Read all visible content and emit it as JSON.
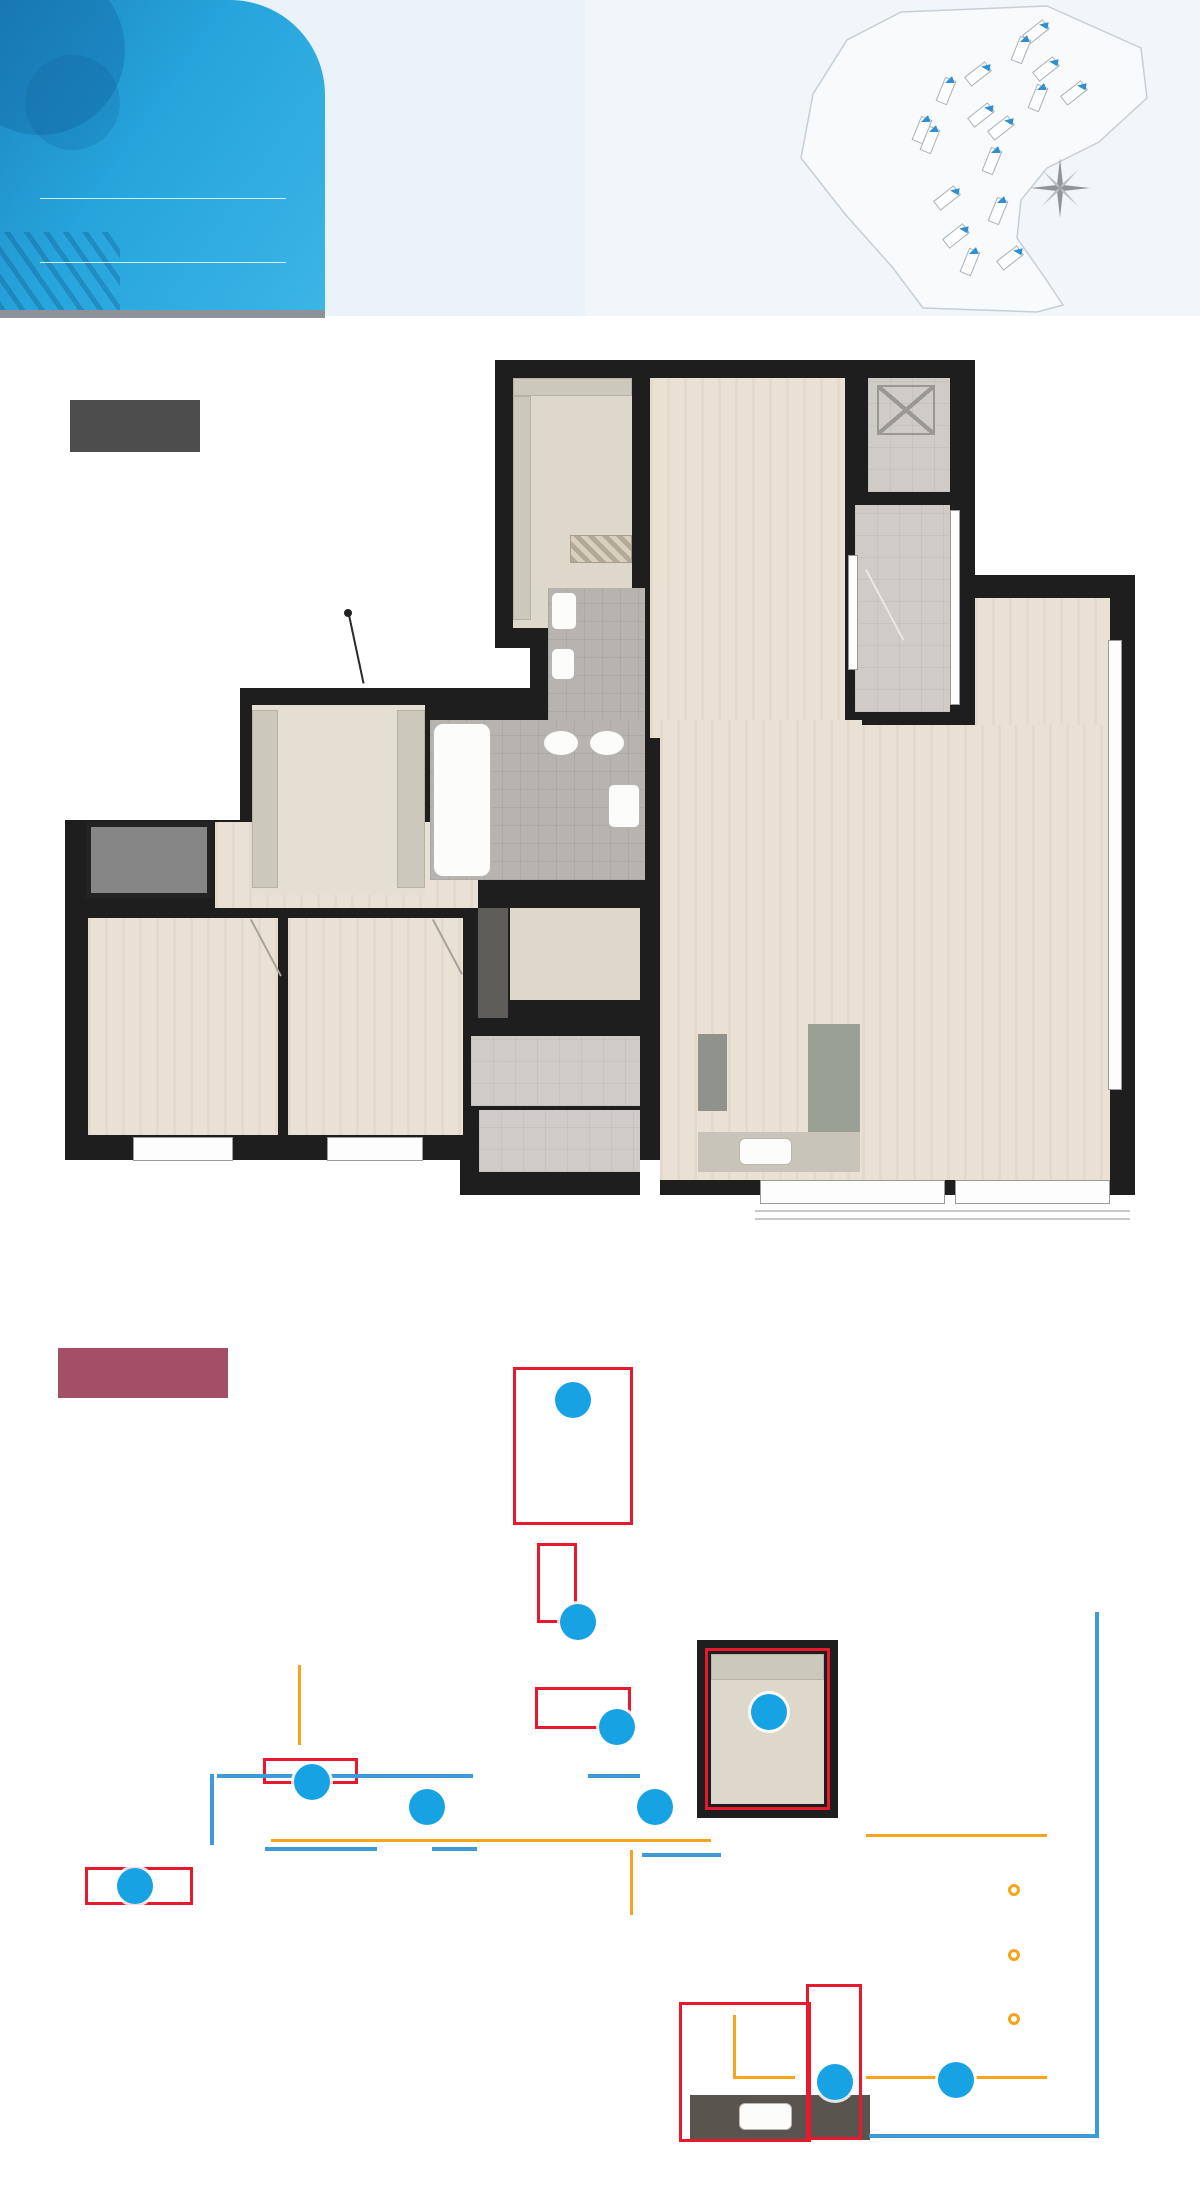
{
  "header": {
    "area_size": "84",
    "area_unit": "m",
    "area_sup": "2",
    "area_type": "B",
    "household_prefix": "총 1,575세대 중",
    "household_strong": "419세대",
    "compass_n": "N",
    "buildings": [
      {
        "name": "101동"
      },
      {
        "name": "102동"
      },
      {
        "name": "103동"
      },
      {
        "name": "104동"
      },
      {
        "name": "105동"
      },
      {
        "name": "106동"
      },
      {
        "name": "107동"
      },
      {
        "name": "108동"
      },
      {
        "name": "109동"
      },
      {
        "name": "110동"
      },
      {
        "name": "111동"
      },
      {
        "name": "112동"
      },
      {
        "name": "113동"
      },
      {
        "name": "114동"
      },
      {
        "name": "115동"
      },
      {
        "name": "116동"
      },
      {
        "name": "117동"
      }
    ]
  },
  "plans": {
    "plan1_label": "확장형",
    "plan2_label": "확장옵션형"
  },
  "rooms": {
    "dressroom": "드레스룸",
    "master": "안방",
    "evac_line1": "하향식",
    "evac_line2": "피난공간",
    "balcony1": "발코니1",
    "bath2": "욕실2",
    "entrance": "현관",
    "bath1": "욕실1",
    "pantry": "팬트리",
    "bed1": "침실1",
    "bed2": "침실2",
    "balcony2": "발코니2",
    "outdoor_unit": "실외기실",
    "kitchen": "주방&식당",
    "living": "거 실",
    "alpha_line1": "안방",
    "alpha_line2": "알파룸"
  },
  "badges": {
    "b1": "1",
    "b2": "2",
    "b3": "3",
    "b4": "4",
    "b5": "5",
    "b6": "6",
    "b7": "7",
    "b8": "8",
    "b9": "9"
  },
  "colors": {
    "badge_blue": "#26a5dc",
    "option_badge_blue": "#17a2e3",
    "option_red": "#e8192c",
    "line_blue": "#3d9bd8",
    "line_orange": "#f7a41d",
    "plan1_label_bg": "#4d4d4d",
    "plan2_label_bg": "#a34f68",
    "wall": "#1e1e1e"
  }
}
